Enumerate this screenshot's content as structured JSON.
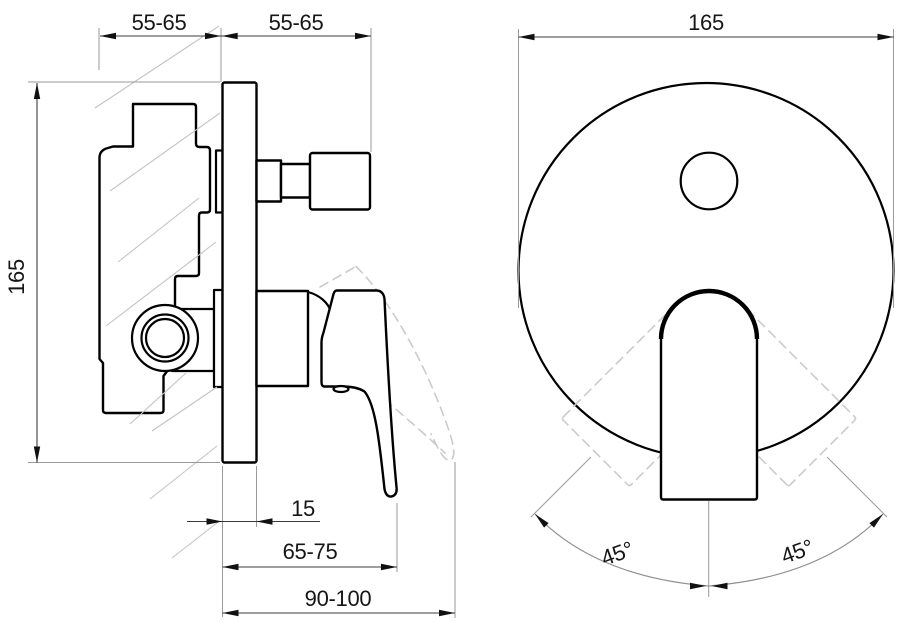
{
  "title": "Concealed single-lever shower mixer installation drawing",
  "side_view": {
    "dim_depth_behind_wall": "55-65",
    "dim_depth_in_front": "55-65",
    "dim_height": "165",
    "dim_plate_thickness": "15",
    "dim_lever_projection": "65-75",
    "dim_total_projection": "90-100"
  },
  "front_view": {
    "dim_plate_diameter": "165",
    "dim_swing_angle_left": "45°",
    "dim_swing_angle_right": "45°"
  },
  "colors": {
    "line": "#000000",
    "dimension": "#3c3c3c",
    "extension": "#9a9a9a",
    "ghost": "#cbcbcb",
    "hatch": "#c3c3c3",
    "background": "#ffffff"
  }
}
